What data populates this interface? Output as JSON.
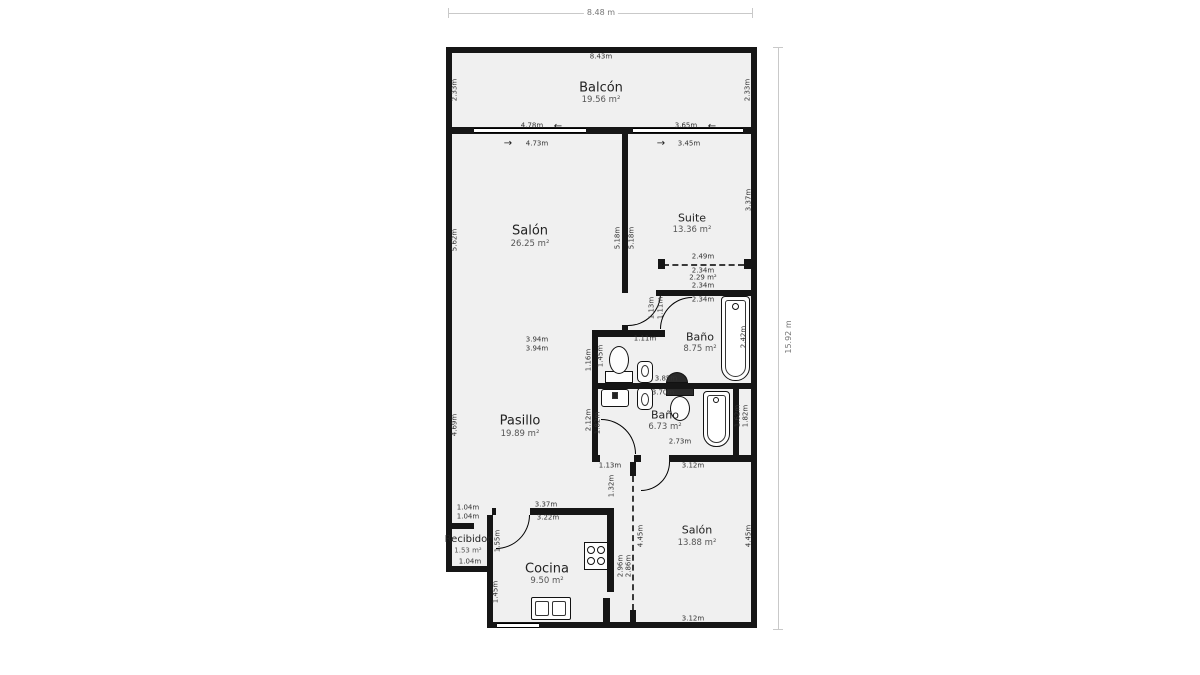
{
  "plan_title": "floor-plan",
  "colors": {
    "wall": "#161616",
    "room_fill": "#f0f0f0",
    "dim_text": "#333333",
    "outer_dim_text": "#777777"
  },
  "overall": {
    "width_label": "8.48 m",
    "height_label": "15.92 m"
  },
  "icons": {
    "arrow_left": "←",
    "arrow_right": "→"
  },
  "rooms": [
    {
      "name": "Balcón",
      "area": "19.56 m²"
    },
    {
      "name": "Salón",
      "area": "26.25 m²"
    },
    {
      "name": "Suite",
      "area": "13.36 m²"
    },
    {
      "name": "Baño",
      "area": "8.75 m²"
    },
    {
      "name": "Baño",
      "area": "6.73 m²"
    },
    {
      "name": "Pasillo",
      "area": "19.89 m²"
    },
    {
      "name": "Recibidor",
      "area": "1.53 m²"
    },
    {
      "name": "Cocina",
      "area": "9.50 m²"
    },
    {
      "name": "Salón",
      "area": "13.88 m²"
    }
  ],
  "dims": [
    "8.43m",
    "2.33m",
    "2.33m",
    "4.78m",
    "4.73m",
    "3.65m",
    "3.45m",
    "5.62m",
    "5.18m",
    "5.18m",
    "3.94m",
    "3.94m",
    "3.37m",
    "2.49m",
    "2.34m",
    "2.29 m²",
    "2.34m",
    "2.34m",
    "1.13m",
    "1.11m",
    "1.11m",
    "3.85m",
    "1.45m",
    "1.16m",
    "2.42m",
    "3.70m",
    "2.12m",
    "1.82m",
    "1.62m",
    "1.82m",
    "2.73m",
    "1.13m",
    "3.12m",
    "4.69m",
    "1.04m",
    "1.04m",
    "3.37m",
    "3.22m",
    "1.04m",
    "1.55m",
    "1.45m",
    "1.32m",
    "2.96m",
    "2.86m",
    "4.45m",
    "4.45m",
    "3.12m"
  ]
}
